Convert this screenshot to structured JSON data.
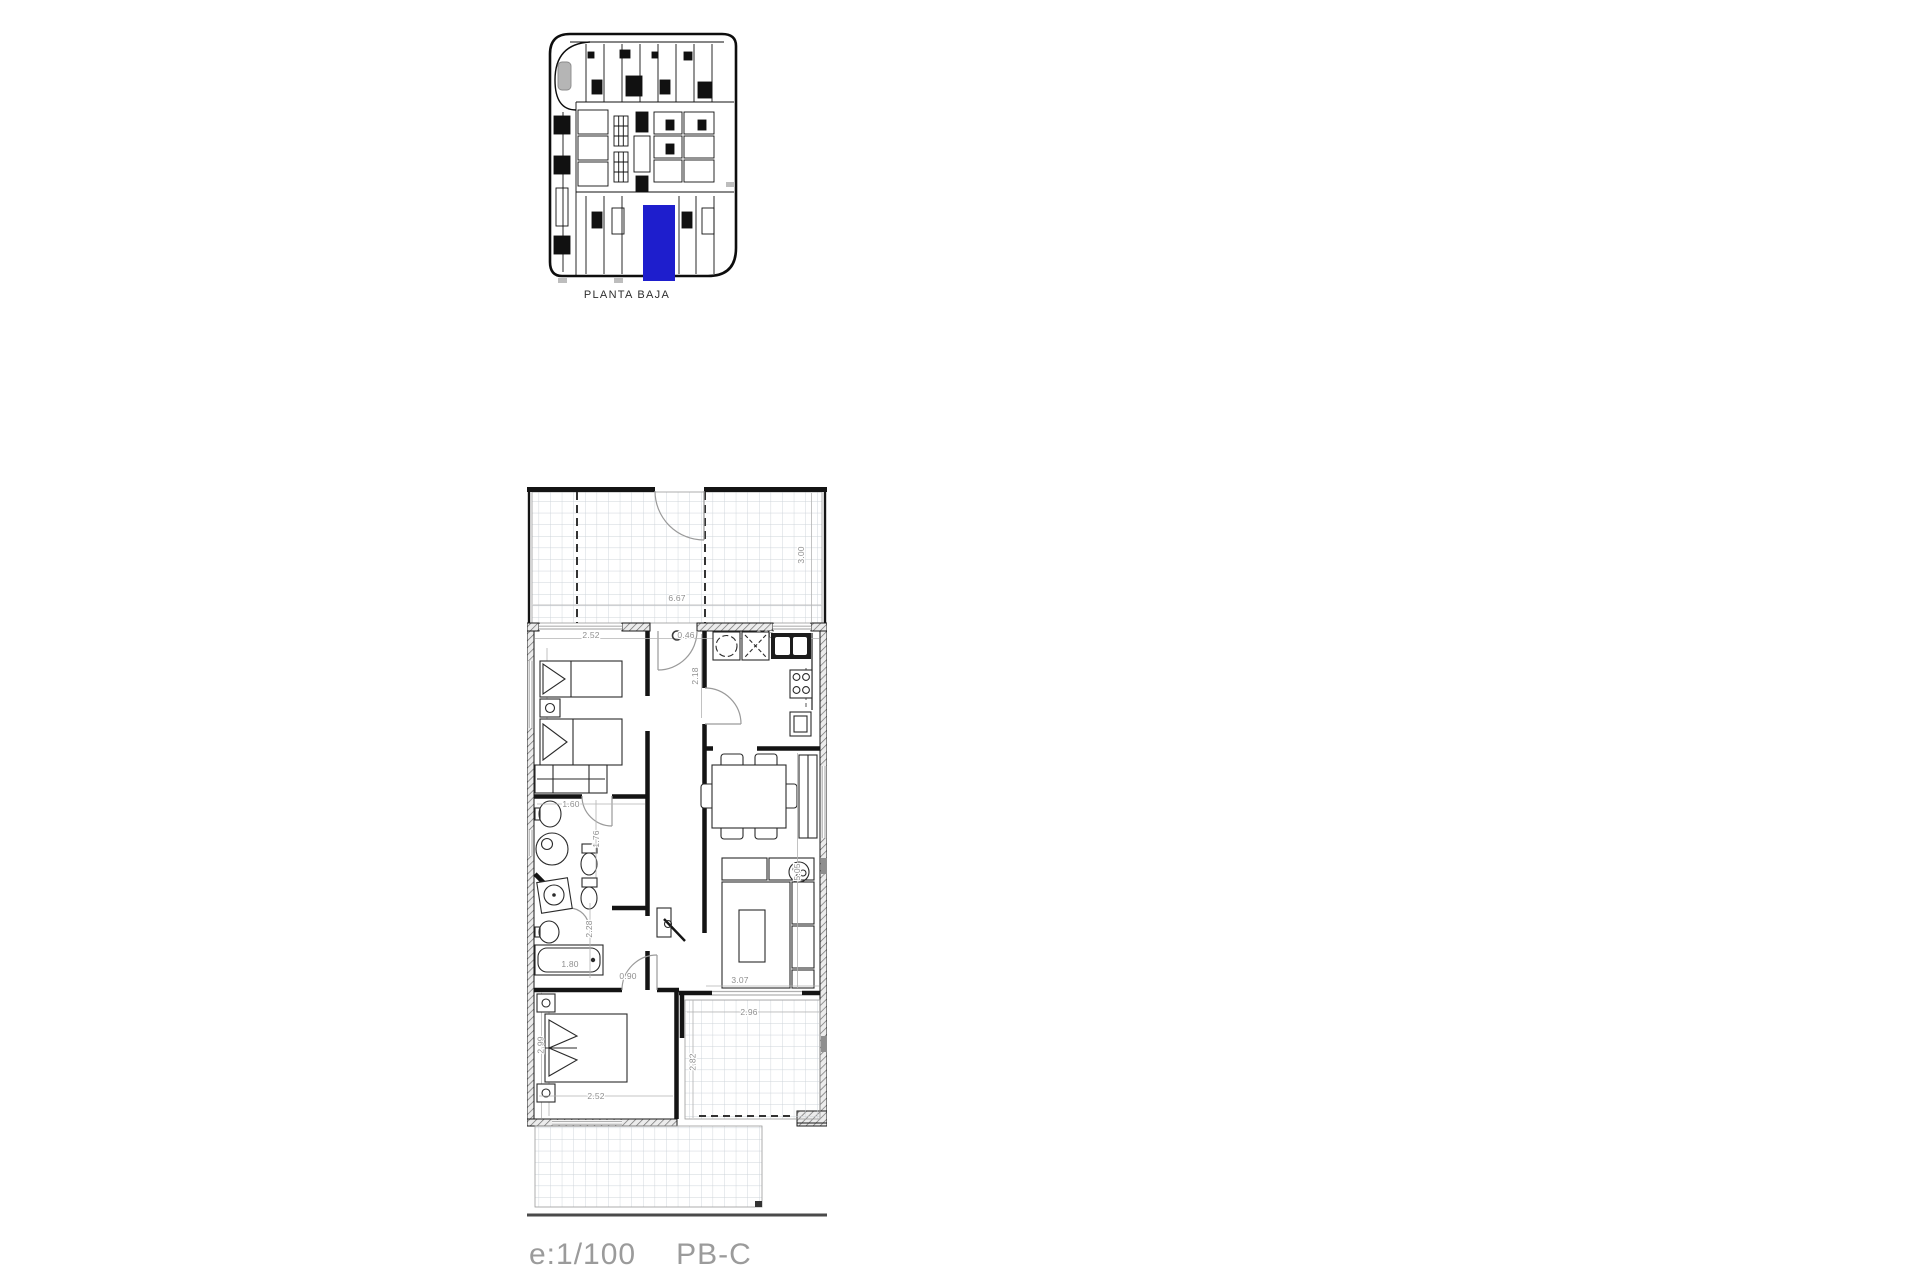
{
  "overview": {
    "caption": "PLANTA BAJA",
    "highlight_color": "#1e1ecd"
  },
  "floorplan": {
    "dim_color": "#8f8f8f",
    "dims": {
      "terrace_width": "6.67",
      "terrace_depth": "3.00",
      "bedroom1_width": "2.52",
      "entry_width": "0.46",
      "kitchen_width": "2.30",
      "hall_depth": "2.18",
      "bath1_width": "1.60",
      "bath1_depth": "1.76",
      "bath2_depth": "2.28",
      "bathtub_length": "1.80",
      "corridor_width": "0.90",
      "living_depth": "5.05",
      "living_width": "3.07",
      "terrace2_width": "2.96",
      "terrace2_depth": "2.82",
      "bedroom2_width": "2.52",
      "bedroom2_depth": "2.99"
    }
  },
  "footer": {
    "scale": "e:1/100",
    "plan_code": "PB-C"
  }
}
